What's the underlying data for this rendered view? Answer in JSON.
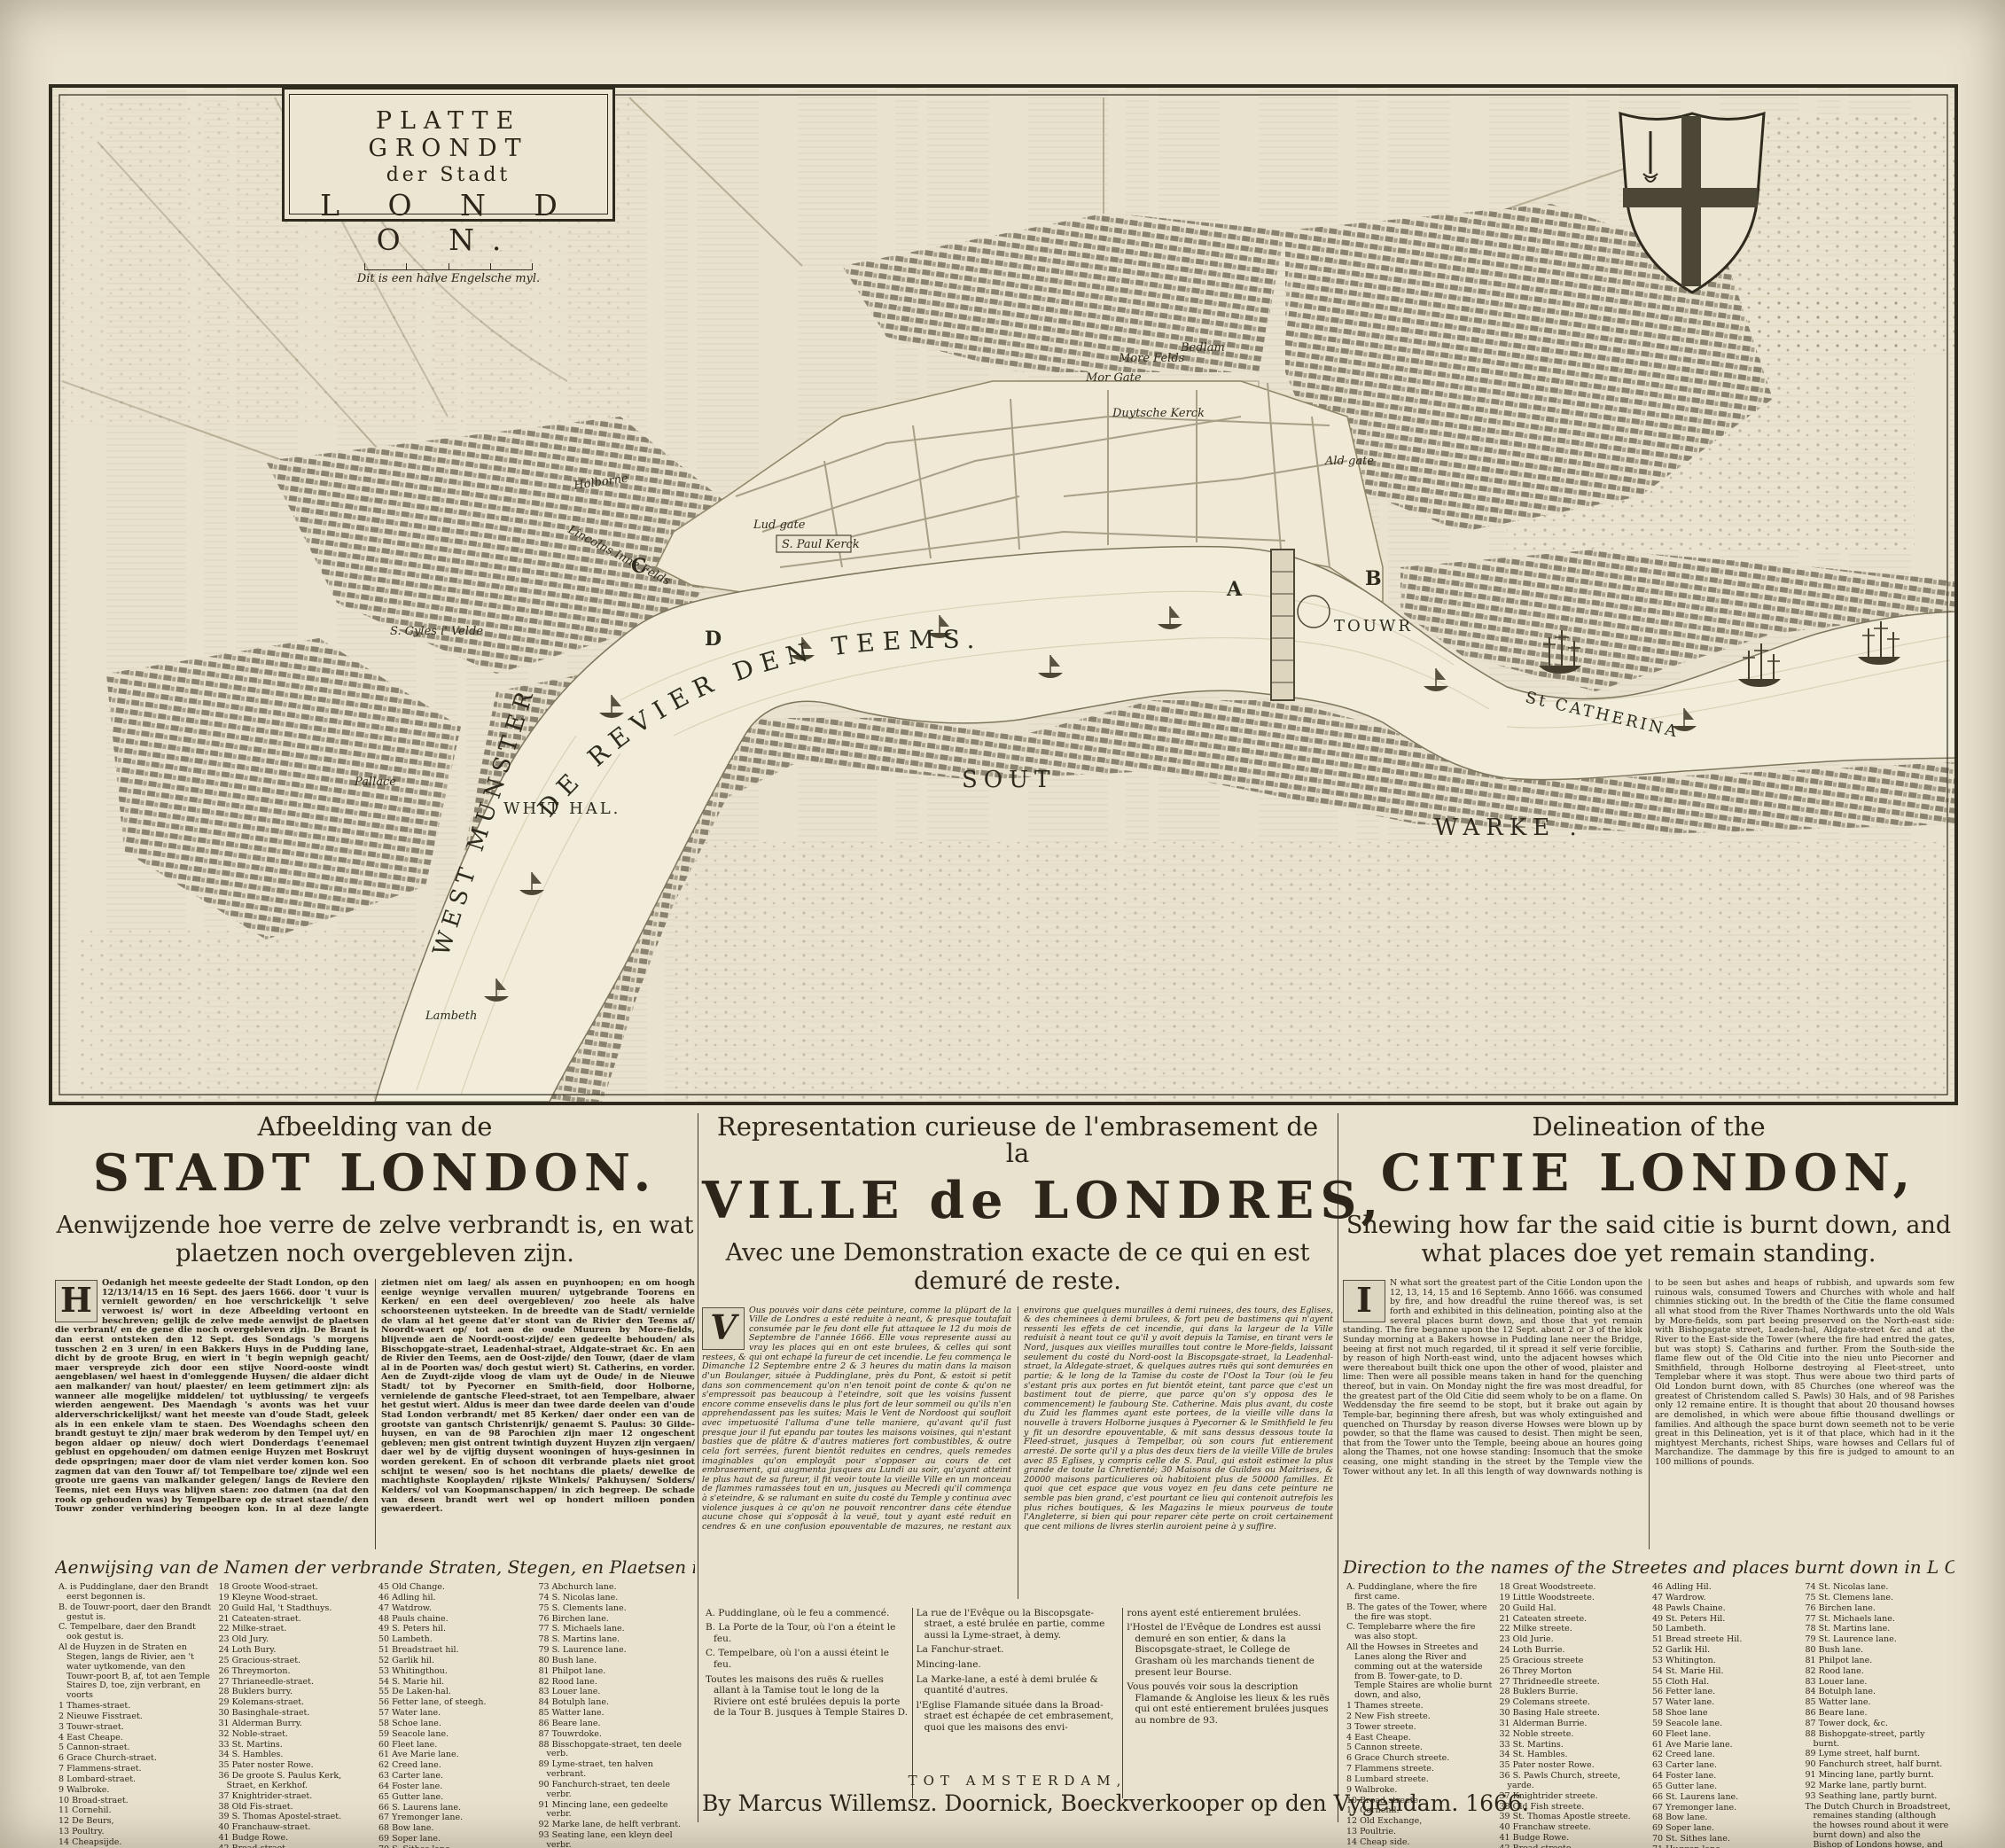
{
  "map": {
    "cartouche": {
      "line1": "PLATTE GRONDT",
      "line2": "der Stadt",
      "line3": "L O N D O N.",
      "scale_note": "Dit is een halve Engelsche myl."
    },
    "river_label": "DE  REVIER  DEN  TEEMS.",
    "labels": {
      "whit_hal": "WHIT HAL.",
      "west_munster": "WEST MUNSTER",
      "sout": "SOUT",
      "warke": "WARKE .",
      "st_catherina": "St CATHERINA",
      "touwr": "TOUWR",
      "pallace": "Pallace",
      "lambeth": "Lambeth",
      "s_gyles": "S. Gyles i' Velde",
      "holborne": "Holborne",
      "lincolns": "Lincolns Inne Felds",
      "s_paul": "S. Paul Kerck",
      "lud_gate": "Lud gate",
      "mor_gate": "Mor Gate",
      "more_felds": "More Felds",
      "bedlam": "Bedlam",
      "duytsche_kerck": "Duytsche Kerck",
      "ald_gate": "Ald gate"
    },
    "markers": {
      "a": "A",
      "b": "B",
      "c": "C",
      "d": "D"
    }
  },
  "dutch": {
    "head": "Afbeelding van de",
    "title": "STADT LONDON.",
    "subtitle": "Aenwijzende hoe verre de zelve verbrandt is, en wat plaetzen noch overgebleven zijn.",
    "initial": "H",
    "body": "Oedanigh het meeste gedeelte der Stadt London, op den 12/13/14/15 en 16 Sept. des jaers 1666. door 't vuur is vernielt geworden/ en hoe verschrickelijk 't selve verwoest is/ wort in deze Afbeelding vertoont en beschreven; gelijk de zelve mede aenwijst de plaetsen die verbrant/ en de gene die noch overgebleven zijn. De Brant is dan eerst ontsteken den 12 Sept. des Sondags 's morgens tusschen 2 en 3 uren/ in een Bakkers Huys in de Pudding lane, dicht by de groote Brug, en wiert in 't begin wepnigh geacht/ maer verspreyde zich door een stijve Noord-ooste windt aengeblasen/ wel haest in d'omleggende Huysen/ die aldaer dicht aen malkander/ van hout/ plaester/ en leem getimmert zijn: als wanneer alle mogelijke middelen/ tot uytblussing/ te vergeefs wierden aengewent. Des Maendagh 's avonts was het vuur alderverschrickelijkst/ want het meeste van d'oude Stadt, geleek als in een enkele vlam te staen. Des Woendaghs scheen den brandt gestuyt te zijn/ maer brak wederom by den Tempel uyt/ en begon aldaer op nieuw/ doch wiert Donderdags t'eenemael geblust en opgehouden/ om datmen eenige Huyzen met Boskruyt dede opspringen; maer door de vlam niet verder komen kon. Soo zagmen dat van den Touwr af/ tot Tempelbare toe/ zijnde wel een groote ure gaens van malkander gelegen/ langs de Reviere den Teems, niet een Huys was blijven staen: zoo datmen (na dat den rook op gehouden was) by Tempelbare op de straet staende/ den Touwr zonder verhindering beoogen kon. In al deze langte zietmen niet om laeg/ als assen en puynhoopen; en om hoogh eenige weynige vervallen muuren/ uytgebrande Toorens en Kerken/ en een deel overgebleven/ zoo heele als halve schoorsteenen uytsteeken. In de breedte van de Stadt/ vernielde de vlam al het geene dat'er stont van de Rivier den Teems af/ Noordt-waert op/ tot aen de oude Muuren by More-fields, blijvende aen de Noordt-oost-zijde/ een gedeelte behouden/ als Bisschopgate-straet, Leadenhal-straet, Aldgate-straet &c. En aen de Rivier den Teems, aen de Oost-zijde/ den Touwr, (daer de vlam al in de Poorten was/ doch gestut wiert) St. Catherins, en vorder. Aen de Zuydt-zijde vloog de vlam uyt de Oude/ in de Nieuwe Stadt/ tot by Pyecorner en Smith-field, door Holborne, vernielende de gantsche Fleed-straet, tot aen Tempelbare, alwaer het gestut wiert. Aldus is meer dan twee darde deelen van d'oude Stad London verbrandt/ met 85 Kerken/ daer onder een van de grootste van gantsch Christenrijk/ genaemt S. Paulus: 30 Gilde-huysen, en van de 98 Parochien zijn maer 12 ongeschent gebleven; men gist ontrent twintigh duyzent Huyzen zijn vergaen/ daer wel by de vijftig duysent wooningen of huys-gesinnen in worden gerekent. En of schoon dit verbrande plaets niet groot schijnt te wesen/ soo is het nochtans die plaets/ dewelke de machtighste Kooplayden/ rijkste Winkels/ Pakhuysen/ Solders/ Kelders/ vol van Koopmanschappen/ in zich begreep. De schade van desen brandt wert wel op hondert milioen ponden gewaerdeert.",
    "list_header": "Aenwijsing van de Namen der verbrande Straten, Stegen, en Plaetsen in L O N D O N.",
    "list_col1": [
      "A. is Puddinglane, daer den Brandt eerst begonnen is.",
      "B. de Touwr-poort, daer den Brandt gestut is.",
      "C. Tempelbare, daer den Brandt ook gestut is.",
      "Al de Huyzen in de Straten en Stegen, langs de Rivier, aen 't water uytkomende, van den Touwr-poort B, af, tot aen Temple Staires D, toe, zijn verbrant, en voorts",
      "1 Thames-straet.",
      "2 Nieuwe Fisstraet.",
      "3 Touwr-straet.",
      "4 East Cheape.",
      "5 Cannon-straet.",
      "6 Grace Church-straet.",
      "7 Flammens-straet.",
      "8 Lombard-straet.",
      "9 Walbroke.",
      "10 Broad-straet.",
      "11 Cornehil.",
      "12 De Beurs,",
      "13 Poultry.",
      "14 Cheapsijde.",
      "15 Neuw-gate-market,",
      "16 Holborne.",
      "17 Fleete-straet."
    ],
    "list_col2": [
      "18 Groote Wood-straet.",
      "19 Kleyne Wood-straet.",
      "20 Guild Hal, 't Stadthuys.",
      "21 Cateaten-straet.",
      "22 Milke-straet.",
      "23 Old Jury.",
      "24 Loth Bury.",
      "25 Gracious-straet.",
      "26 Threymorton.",
      "27 Thrianeedle-straet.",
      "28 Buklers burry.",
      "29 Kolemans-straet.",
      "30 Basinghale-straet.",
      "31 Alderman Burry.",
      "32 Noble-straet.",
      "33 St. Martins.",
      "34 S. Hambles.",
      "35 Pater noster Rowe.",
      "36 De groote S. Paulus Kerk, Straet, en Kerkhof.",
      "37 Knightrider-straet.",
      "38 Old Fis-straet.",
      "39 S. Thomas Apostel-straet.",
      "40 Franchauw-straet.",
      "41 Budge Rowe.",
      "42 Bread-straet.",
      "43 Watling-straet.",
      "44 Friday-straet."
    ],
    "list_col3": [
      "45 Old Change.",
      "46 Adling hil.",
      "47 Watdrow.",
      "48 Pauls chaine.",
      "49 S. Peters hil.",
      "50 Lambeth.",
      "51 Breadstraet hil.",
      "52 Garlik hil.",
      "53 Whitingthou.",
      "54 S. Marie hil.",
      "55 De Laken-hal.",
      "56 Fetter lane, of steegh.",
      "57 Water lane.",
      "58 Schoe lane.",
      "59 Seacole lane.",
      "60 Fleet lane.",
      "61 Ave Marie lane.",
      "62 Creed lane.",
      "63 Carter lane.",
      "64 Foster lane.",
      "65 Gutter lane.",
      "66 S. Laurens lane.",
      "67 Yremonger lane.",
      "68 Bow lane.",
      "69 Soper lane.",
      "70 S. Sithes lane.",
      "71 Huggen lane.",
      "72 S. Switkens lane."
    ],
    "list_col4": [
      "73 Abchurch lane.",
      "74 S. Nicolas lane.",
      "75 S. Clements lane.",
      "76 Birchen lane.",
      "77 S. Michaels lane.",
      "78 S. Martins lane.",
      "79 S. Laurence lane.",
      "80 Bush lane.",
      "81 Philpot lane.",
      "82 Rood lane.",
      "83 Louer lane.",
      "84 Botulph lane.",
      "85 Watter lane.",
      "86 Beare lane.",
      "87 Touwrdoke.",
      "88 Bisschopgate-straet, ten deele verb.",
      "89 Lyme-straet, ten halven verbrant.",
      "90 Fanchurch-straet, ten deele verbr.",
      "91 Mincing lane, een gedeelte verbr.",
      "92 Marke lane, de helft verbrant.",
      "93 Seating lane, een kleyn deel verbr.",
      "De Duytsche Kerk (in de Broadstraet) is blijven staen, schoon dat de Huysen rondom de zelve verbrant zijn. Als ook den Bisschop van Londons Huys: en Grasham Colledge, in Bisschopgate straet, daer nu de Kooplayden hun Beurs-tijdt houden."
    ]
  },
  "french": {
    "head": "Representation curieuse de l'embrasement de la",
    "title": "VILLE de LONDRES,",
    "subtitle": "Avec une Demonstration exacte de ce qui en est demuré de reste.",
    "initial": "V",
    "body": "Ous pouvés voir dans cète peinture, comme la plûpart de la Ville de Londres a esté reduite à neant, & presque toutafait consumée par le feu dont elle fut attaquee le 12 du mois de Septembre de l'année 1666. Elle vous represente aussi au vray les places qui en ont este brulees, & celles qui sont restees, & qui ont echapé la fureur de cet incendie. Le feu commença le Dimanche 12 Septembre entre 2 & 3 heures du matin dans la maison d'un Boulanger, située à Puddinglane, près du Pont, & estoit si petit dans son commencement qu'on n'en tenoit point de conte & qu'on ne s'empressoit pas beaucoup à l'eteindre, soit que les voisins fussent encore comme ensevelis dans le plus fort de leur sommeil ou qu'ils n'en apprehendassent pas les suites; Mais le Vent de Nordoost qui soufloit avec impetuosité l'alluma d'une telle maniere, qu'avant qu'il fust presque jour il fut epandu par toutes les maisons voisines, qui n'estant basties que de plâtre & d'autres matieres fort combustibles, & outre cela fort serrées, furent bientôt reduites en cendres, quels remedes imaginables qu'on employât pour s'opposer au cours de cet embrasement, qui augmenta jusques au Lundi au soir, qu'ayant atteint le plus haut de sa fureur, il fit veoir toute la vieille Ville en un monceau de flammes ramassées tout en un, jusques au Mecredi qu'il commença à s'eteindre, & se ralumant en suite du costé du Temple y continua avec violence jusques à ce qu'on ne pouvoit rencontrer dans céte étendue aucune chose qui s'opposât à la veuë, tout y ayant esté reduit en cendres & en une confusion epouventable de mazures, ne restant aux environs que quelques murailles à demi ruinees, des tours, des Eglises, & des cheminees à demi brulees, & fort peu de bastimens qui n'ayent ressenti les effets de cet incendie, qui dans la largeur de la Ville reduisit à neant tout ce qu'il y avoit depuis la Tamise, en tirant vers le Nord, jusques aux vieilles murailles tout contre le More-fields, laissant seulement du costé du Nord-oost la Biscopsgate-straet, la Leadenhal-straet, la Aldegate-straet, & quelques autres ruës qui sont demurées en partie; & le long de la Tamise du coste de l'Oost la Tour (où le feu s'estant pris aux portes en fut bientôt eteint, tant parce que c'est un bastiment tout de pierre, que parce qu'on s'y opposa des le commencement) le faubourg Ste. Catherine. Mais plus avant, du coste du Zuid les flammes ayant este portees, de la vieille ville dans la nouvelle à travers Holborne jusques à Pyecorner & le Smithfield le feu y fit un desordre epouventable, & mit sans dessus dessous toute la Fleed-straet, jusques à Tempelbar, où son cours fut entierement arresté. De sorte qu'il y a plus des deux tiers de la vieille Ville de brules avec 85 Eglises, y compris celle de S. Paul, qui estoit estimee la plus grande de toute la Chretienté; 30 Maisons de Guildes ou Maitrises, & 20000 maisons particulieres où habitoient plus de 50000 familles. Et quoi que cet espace que vous voyez en feu dans cete peinture ne semble pas bien grand, c'est pourtant ce lieu qui contenoit autrefois les plus riches boutiques, & les Magazins le mieux pourveus de toute l'Angleterre, si bien qui pour reparer cète perte on croit certainement que cent milions de livres sterlin auroient peine à y suffire.",
    "list_col1": [
      "A. Puddinglane, où le feu a commencé.",
      "B. La Porte de la Tour, où l'on a éteint le feu.",
      "C. Tempelbare, où l'on a aussi éteint le feu.",
      "Toutes les maisons des ruës & ruelles allant à la Tamise tout le long de la Riviere ont esté brulées depuis la porte de la Tour B. jusques à Temple Staires D."
    ],
    "list_col2": [
      "La rue de l'Evêque ou la Biscopsgate-straet, a esté brulée en partie, comme aussi la Lyme-straet, à demy.",
      "La Fanchur-straet.",
      "Mincing-lane.",
      "La Marke-lane, a esté à demi brulée & quantité d'autres.",
      "l'Eglise Flamande située dans la Broad-straet est échapée de cet embrasement, quoi que les maisons des envi-"
    ],
    "list_col3": [
      "rons ayent esté entierement brulées.",
      "l'Hostel de l'Evêque de Londres est aussi demuré en son entier, & dans la Biscopsgate-straet, le College de Grasham où les marchands tienent de present leur Bourse.",
      "Vous pouvés voir sous la description Flamande & Angloise les lieux & les ruës qui ont esté entierement brulées jusques au nombre de 93."
    ]
  },
  "english": {
    "head": "Delineation of the",
    "title": "CITIE LONDON,",
    "subtitle": "Shewing how far the said citie is burnt down, and what places doe yet remain standing.",
    "initial": "I",
    "body": "N what sort the greatest part of the Citie London upon the 12, 13, 14, 15 and 16 Septemb. Anno 1666. was consumed by fire, and how dreadful the ruine thereof was, is set forth and exhibited in this delineation, pointing also at the several places burnt down, and those that yet remain standing. The fire beganne upon the 12 Sept. about 2 or 3 of the klok Sunday morning at a Bakers howse in Pudding lane neer the Bridge, beeing at first not much regarded, til it spread it self verie forciblie, by reason of high North-east wind, unto the adjacent howses which were thereabout built thick one upon the other of wood, plaister and lime: Then were all possible means taken in hand for the quenching thereof, but in vain. On Monday night the fire was most dreadful, for the greatest part of the Old Citie did seem wholy to be on a flame. On Weddensday the fire seemd to be stopt, but it brake out again by Temple-bar, beginning there afresh, but was wholy extinguished and quenched on Thursday by reason diverse Howses were blown up by powder, so that the flame was caused to desist. Then might be seen, that from the Tower unto the Temple, beeing aboue an houres going along the Thames, not one howse standing: Insomuch that the smoke ceasing, one might standing in the street by the Temple view the Tower without any let. In all this length of way downwards nothing is to be seen but ashes and heaps of rubbish, and upwards som few ruinous wals, consumed Towers and Churches with whole and half chimnies sticking out. In the bredth of the Citie the flame consumed all what stood from the River Thames Northwards unto the old Wals by More-fields, som part beeing preserved on the North-east side: with Bishopsgate street, Leaden-hal, Aldgate-street &c and at the River to the East-side the Tower (where the fire had entred the gates, but was stopt) S. Catharins and further. From the South-side the flame flew out of the Old Citie into the nieu unto Piecorner and Smithfield, through Holborne destroying al Fleet-street, unto Templebar where it was stopt. Thus were aboue two third parts of Old London burnt down, with 85 Churches (one whereof was the greatest of Christendom called S. Pawls) 30 Hals, and of 98 Parishes only 12 remaine entire. It is thought that about 20 thousand howses are demolished, in which were aboue fiftie thousand dwellings or families. And although the space burnt down seemeth not to be verie great in this Delineation, yet is it of that place, which had in it the mightyest Merchants, richest Ships, ware howses and Cellars ful of Marchandize. The dammage by this fire is judged to amount to an 100 millions of pounds.",
    "list_header": "Direction to the names of the Streetes and places burnt down in L O N D O N.",
    "list_col1": [
      "A. Puddinglane, where the fire first came.",
      "B. The gates of the Tower, where the fire was stopt.",
      "C. Templebarre where the fire was also stopt.",
      "All the Howses in Streetes and Lanes along the River and comming out at the waterside from B. Tower-gate, to D. Temple Staires are wholie burnt down, and also,",
      "1 Thames streete.",
      "2 New Fish streete.",
      "3 Tower streete.",
      "4 East Cheape.",
      "5 Cannon streete.",
      "6 Grace Church streete.",
      "7 Flammens streete.",
      "8 Lumbard streete.",
      "9 Walbroke.",
      "10 Broad streete.",
      "11 Cornehil.",
      "12 Old Exchange,",
      "13 Poultrie.",
      "14 Cheap side.",
      "15 New gate Market,",
      "16 Holborne.",
      "17 Fleete streete."
    ],
    "list_col2": [
      "18 Great Woodstreete.",
      "19 Little Woodstreete.",
      "20 Guild Hal.",
      "21 Cateaten streete.",
      "22 Milke streete.",
      "23 Old Jurie.",
      "24 Loth Burrie.",
      "25 Gracious streete",
      "26 Threy Morton",
      "27 Thridneedle streete.",
      "28 Buklers Burrie.",
      "29 Colemans streete.",
      "30 Basing Hale streete.",
      "31 Alderman Burrie.",
      "32 Noble streete.",
      "33 St. Martins.",
      "34 St. Hambles.",
      "35 Pater noster Rowe.",
      "36 S. Pawls Church, streete, yarde.",
      "37 Knightrider streete.",
      "38 Old Fish streete.",
      "39 St. Thomas Apostle streete.",
      "40 Franchaw streete.",
      "41 Budge Rowe.",
      "42 Bread streete.",
      "43 Watling streete.",
      "44 Friday streete.",
      "45 Old Change,"
    ],
    "list_col3": [
      "46 Adling Hil.",
      "47 Wardrow.",
      "48 Pawls Chaine.",
      "49 St. Peters Hil.",
      "50 Lambeth.",
      "51 Bread streete Hil.",
      "52 Garlik Hil.",
      "53 Whitington.",
      "54 St. Marie Hil.",
      "55 Cloth Hal.",
      "56 Fetter lane.",
      "57 Water lane.",
      "58 Shoe lane",
      "59 Seacole lane.",
      "60 Fleet lane.",
      "61 Ave Marie lane.",
      "62 Creed lane.",
      "63 Carter lane.",
      "64 Foster lane.",
      "65 Gutter lane.",
      "66 St. Laurens lane.",
      "67 Yremonger lane.",
      "68 Bow lane.",
      "69 Soper lane.",
      "70 St. Sithes lane.",
      "71 Huggen lane.",
      "72 St. Switkens lane,",
      "73 Abchurch lane,"
    ],
    "list_col4": [
      "74 St. Nicolas lane.",
      "75 St. Clemens lane.",
      "76 Birchen lane.",
      "77 St. Michaels lane.",
      "78 St. Martins lane.",
      "79 St. Laurence lane.",
      "80 Bush lane.",
      "81 Philpot lane.",
      "82 Rood lane.",
      "83 Louer lane.",
      "84 Botulph lane.",
      "85 Watter lane.",
      "86 Beare lane.",
      "87 Tower dock, &c.",
      "88 Bishopgate-street, partly burnt.",
      "89 Lyme street, half burnt.",
      "90 Fanchurch street, half burnt.",
      "91 Mincing lane, partly burnt.",
      "92 Marke lane, partly burnt.",
      "93 Seathing lane, partly burnt.",
      "The Dutch Church in Broadstreet, remaines standing (although the howses round about it were burnt down) and also the Bishop of Londons howse, and Grasham Colledge in Bishopgatestreet, where now merchants keep their Exchange meetings."
    ]
  },
  "imprint": {
    "city": "TOT  AMSTERDAM,",
    "line": "By Marcus Willemsz. Doornick, Boeckverkooper op den Vygendam. 1666."
  },
  "colors": {
    "paper": "#e9e2cf",
    "ink": "#2e2a1e",
    "river": "#f2edda"
  }
}
